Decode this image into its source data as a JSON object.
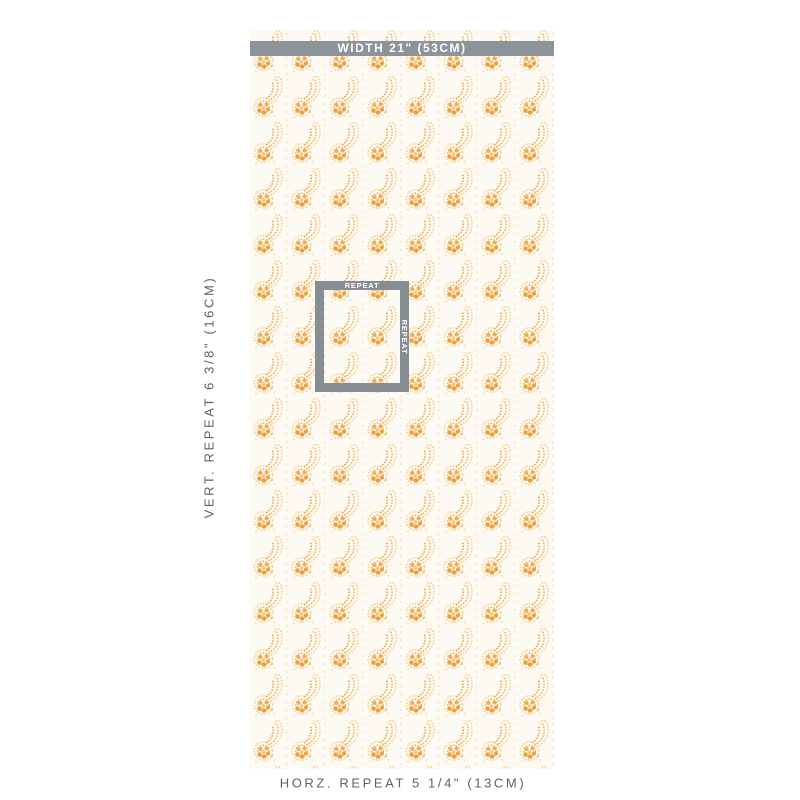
{
  "panel": {
    "name": "wallpaper-swatch-diagram",
    "width_label": "WIDTH 21\" (53CM)",
    "vert_repeat_label": "VERT. REPEAT 6 3/8\" (16CM)",
    "horz_repeat_label": "HORZ. REPEAT 5 1/4\" (13CM)",
    "repeat_box": {
      "top_label": "REPEAT",
      "side_label": "REPEAT"
    },
    "colors": {
      "marker_gray": "#8C9399",
      "repeat_box_gray": "#868E94",
      "label_text_gray": "#5D6367",
      "pattern_gold_dark": "#EAA23E",
      "pattern_gold_mid": "#F0B76A",
      "pattern_gold_light": "#F6D7A2",
      "panel_cream": "#FCFAF2",
      "page_background": "#FFFFFF"
    }
  }
}
